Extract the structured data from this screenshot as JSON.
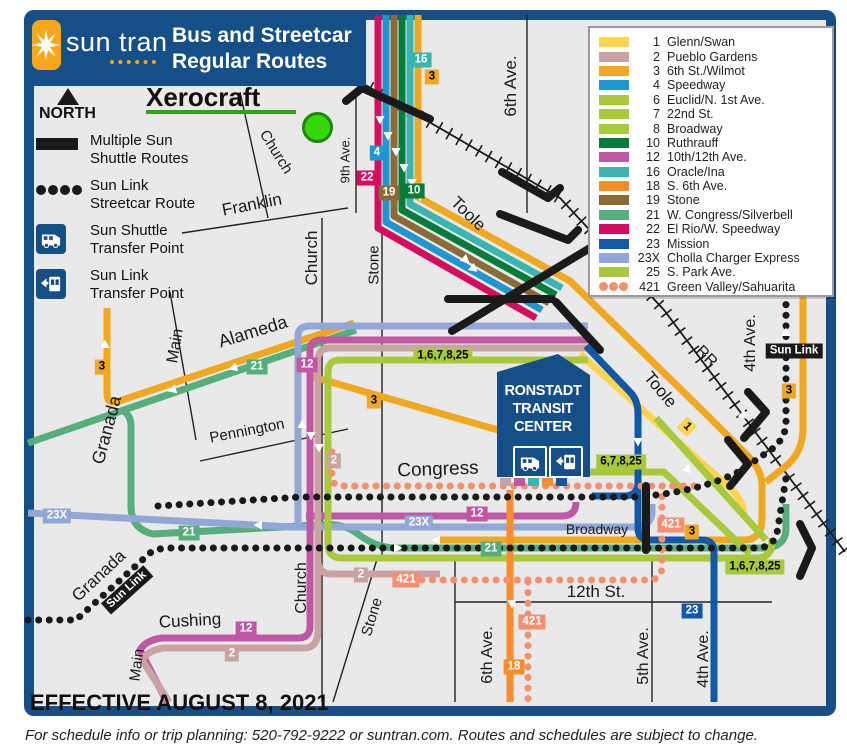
{
  "header": {
    "logo_text": "sun tran",
    "title_line1": "Bus and Streetcar",
    "title_line2": "Regular Routes"
  },
  "compass": {
    "label": "NORTH"
  },
  "poi": {
    "xerocraft": "Xerocraft"
  },
  "map_legend": {
    "items": [
      {
        "icon": "black-bar-swatch",
        "line1": "Multiple Sun",
        "line2": "Shuttle Routes"
      },
      {
        "icon": "black-dots-swatch",
        "line1": "Sun Link",
        "line2": "Streetcar Route"
      },
      {
        "icon": "bus-icon",
        "line1": "Sun Shuttle",
        "line2": "Transfer Point"
      },
      {
        "icon": "tram-icon",
        "line1": "Sun Link",
        "line2": "Transfer Point"
      }
    ]
  },
  "routes_legend": {
    "rows": [
      {
        "number": "1",
        "name": "Glenn/Swan",
        "color": "#FCD450"
      },
      {
        "number": "2",
        "name": "Pueblo Gardens",
        "color": "#C9A2A2"
      },
      {
        "number": "3",
        "name": "6th St./Wilmot",
        "color": "#EFA81F"
      },
      {
        "number": "4",
        "name": "Speedway",
        "color": "#1F96D2"
      },
      {
        "number": "6",
        "name": "Euclid/N. 1st Ave.",
        "color": "#A9C93D"
      },
      {
        "number": "7",
        "name": "22nd St.",
        "color": "#A9C93D"
      },
      {
        "number": "8",
        "name": "Broadway",
        "color": "#A9C93D"
      },
      {
        "number": "10",
        "name": "Ruthrauff",
        "color": "#067C3C"
      },
      {
        "number": "12",
        "name": "10th/12th Ave.",
        "color": "#BF57A5"
      },
      {
        "number": "16",
        "name": "Oracle/Ina",
        "color": "#3BB5B0"
      },
      {
        "number": "18",
        "name": "S. 6th Ave.",
        "color": "#F78D2D"
      },
      {
        "number": "19",
        "name": "Stone",
        "color": "#8A6A36"
      },
      {
        "number": "21",
        "name": "W. Congress/Silverbell",
        "color": "#56AE7C"
      },
      {
        "number": "22",
        "name": "El Rio/W. Speedway",
        "color": "#D40D5F"
      },
      {
        "number": "23",
        "name": "Mission",
        "color": "#1158A7"
      },
      {
        "number": "23X",
        "name": "Cholla Charger Express",
        "color": "#93A7D6"
      },
      {
        "number": "25",
        "name": "S. Park Ave.",
        "color": "#A9C93D"
      },
      {
        "number": "421",
        "name": "Green Valley/Sahuarita",
        "color": "#F29070",
        "dots": true
      }
    ]
  },
  "transit_center": {
    "line1": "RONSTADT",
    "line2": "TRANSIT",
    "line3": "CENTER"
  },
  "effective_date": "EFFECTIVE AUGUST 8, 2021",
  "footer": "For schedule info or trip planning: 520-792-9222 or suntran.com. Routes and schedules are subject to change.",
  "colors": {
    "brand_blue": "#164E87",
    "map_bg": "#E9E9EA",
    "logo_orange": "#F5A81C",
    "xerocraft_green": "#2CA60E",
    "sun_link_black": "#1a1a1a"
  },
  "map": {
    "street_labels": [
      {
        "text": "6th Ave.",
        "x": 511,
        "y": 86,
        "rot": -90,
        "size": 17
      },
      {
        "text": "9th Ave.",
        "x": 345,
        "y": 160,
        "rot": -90,
        "size": 13
      },
      {
        "text": "Church",
        "x": 276,
        "y": 152,
        "rot": 58,
        "size": 15
      },
      {
        "text": "Franklin",
        "x": 252,
        "y": 205,
        "rot": -11,
        "size": 17
      },
      {
        "text": "Church",
        "x": 312,
        "y": 258,
        "rot": -90,
        "size": 17
      },
      {
        "text": "Stone",
        "x": 374,
        "y": 265,
        "rot": -90,
        "size": 15
      },
      {
        "text": "Toole",
        "x": 468,
        "y": 214,
        "rot": 44,
        "size": 17
      },
      {
        "text": "Toole",
        "x": 660,
        "y": 390,
        "rot": 50,
        "size": 17
      },
      {
        "text": "RR",
        "x": 706,
        "y": 357,
        "rot": 45,
        "size": 16
      },
      {
        "text": "Main",
        "x": 176,
        "y": 346,
        "rot": -80,
        "size": 16
      },
      {
        "text": "Alameda",
        "x": 253,
        "y": 332,
        "rot": -17,
        "size": 18
      },
      {
        "text": "Granada",
        "x": 107,
        "y": 430,
        "rot": -75,
        "size": 18
      },
      {
        "text": "Pennington",
        "x": 247,
        "y": 431,
        "rot": -11,
        "size": 15
      },
      {
        "text": "Congress",
        "x": 438,
        "y": 470,
        "rot": -2,
        "size": 19
      },
      {
        "text": "Broadway",
        "x": 597,
        "y": 529,
        "rot": 0,
        "size": 14
      },
      {
        "text": "4th Ave.",
        "x": 751,
        "y": 343,
        "rot": -90,
        "size": 16
      },
      {
        "text": "12th St.",
        "x": 596,
        "y": 592,
        "rot": 0,
        "size": 17
      },
      {
        "text": "Granada",
        "x": 99,
        "y": 576,
        "rot": -43,
        "size": 17
      },
      {
        "text": "Cushing",
        "x": 190,
        "y": 621,
        "rot": -3,
        "size": 17
      },
      {
        "text": "Main",
        "x": 137,
        "y": 665,
        "rot": -82,
        "size": 15
      },
      {
        "text": "Church",
        "x": 302,
        "y": 588,
        "rot": -90,
        "size": 16
      },
      {
        "text": "Stone",
        "x": 372,
        "y": 617,
        "rot": -73,
        "size": 15
      },
      {
        "text": "6th Ave.",
        "x": 488,
        "y": 655,
        "rot": -90,
        "size": 16
      },
      {
        "text": "5th Ave.",
        "x": 644,
        "y": 656,
        "rot": -90,
        "size": 16
      },
      {
        "text": "4th Ave.",
        "x": 704,
        "y": 659,
        "rot": -90,
        "size": 16
      }
    ],
    "badges": [
      {
        "t": "16",
        "x": 421,
        "y": 60,
        "bg": "#3BB5B0",
        "fg": "#fff"
      },
      {
        "t": "3",
        "x": 432,
        "y": 77,
        "bg": "#EFA81F",
        "fg": "#000"
      },
      {
        "t": "4",
        "x": 377,
        "y": 153,
        "bg": "#1F96D2",
        "fg": "#fff"
      },
      {
        "t": "22",
        "x": 367,
        "y": 178,
        "bg": "#D40D5F",
        "fg": "#fff"
      },
      {
        "t": "19",
        "x": 389,
        "y": 193,
        "bg": "#8A6A36",
        "fg": "#fff"
      },
      {
        "t": "10",
        "x": 414,
        "y": 191,
        "bg": "#067C3C",
        "fg": "#fff"
      },
      {
        "t": "3",
        "x": 102,
        "y": 367,
        "bg": "#EFA81F",
        "fg": "#000"
      },
      {
        "t": "21",
        "x": 257,
        "y": 367,
        "bg": "#56AE7C",
        "fg": "#fff"
      },
      {
        "t": "12",
        "x": 307,
        "y": 365,
        "bg": "#BF57A5",
        "fg": "#fff"
      },
      {
        "t": "1,6,7,8,25",
        "x": 443,
        "y": 356,
        "bg": "#A9C93D",
        "fg": "#000"
      },
      {
        "t": "3",
        "x": 374,
        "y": 401,
        "bg": "#EFA81F",
        "fg": "#000"
      },
      {
        "t": "2",
        "x": 334,
        "y": 461,
        "bg": "#C9A2A2",
        "fg": "#fff"
      },
      {
        "t": "6,7,8,25",
        "x": 621,
        "y": 462,
        "bg": "#A9C93D",
        "fg": "#000"
      },
      {
        "t": "421",
        "x": 671,
        "y": 525,
        "bg": "#F29070",
        "fg": "#fff"
      },
      {
        "t": "12",
        "x": 477,
        "y": 514,
        "bg": "#BF57A5",
        "fg": "#fff"
      },
      {
        "t": "23X",
        "x": 419,
        "y": 523,
        "bg": "#93A7D6",
        "fg": "#fff"
      },
      {
        "t": "23X",
        "x": 57,
        "y": 516,
        "bg": "#93A7D6",
        "fg": "#fff"
      },
      {
        "t": "21",
        "x": 189,
        "y": 533,
        "bg": "#56AE7C",
        "fg": "#fff"
      },
      {
        "t": "21",
        "x": 491,
        "y": 549,
        "bg": "#56AE7C",
        "fg": "#fff"
      },
      {
        "t": "3",
        "x": 692,
        "y": 532,
        "bg": "#EFA81F",
        "fg": "#000"
      },
      {
        "t": "1,6,7,8,25",
        "x": 755,
        "y": 567,
        "bg": "#A9C93D",
        "fg": "#000"
      },
      {
        "t": "2",
        "x": 361,
        "y": 575,
        "bg": "#C9A2A2",
        "fg": "#fff"
      },
      {
        "t": "421",
        "x": 406,
        "y": 580,
        "bg": "#F29070",
        "fg": "#fff"
      },
      {
        "t": "421",
        "x": 532,
        "y": 622,
        "bg": "#F29070",
        "fg": "#fff"
      },
      {
        "t": "18",
        "x": 514,
        "y": 667,
        "bg": "#F78D2D",
        "fg": "#fff"
      },
      {
        "t": "23",
        "x": 692,
        "y": 611,
        "bg": "#1158A7",
        "fg": "#fff"
      },
      {
        "t": "12",
        "x": 246,
        "y": 629,
        "bg": "#BF57A5",
        "fg": "#fff"
      },
      {
        "t": "2",
        "x": 232,
        "y": 654,
        "bg": "#C9A2A2",
        "fg": "#fff"
      },
      {
        "t": "3",
        "x": 789,
        "y": 391,
        "bg": "#EFA81F",
        "fg": "#000"
      },
      {
        "t": "1",
        "x": 687,
        "y": 427,
        "bg": "#FCD450",
        "fg": "#000",
        "rot": 45
      },
      {
        "t": "Sun Link",
        "x": 794,
        "y": 351,
        "bg": "#1a1a1a",
        "fg": "#fff"
      },
      {
        "t": "Sun Link",
        "x": 127,
        "y": 590,
        "bg": "#1a1a1a",
        "fg": "#fff",
        "rot": -42
      }
    ],
    "arrows": [
      [
        380,
        120,
        180
      ],
      [
        388,
        136,
        180
      ],
      [
        396,
        152,
        180
      ],
      [
        404,
        168,
        180
      ],
      [
        412,
        183,
        180
      ],
      [
        420,
        197,
        180
      ],
      [
        466,
        260,
        130
      ],
      [
        474,
        269,
        130
      ],
      [
        233,
        368,
        -107
      ],
      [
        172,
        390,
        -107
      ],
      [
        105,
        344,
        0
      ],
      [
        302,
        424,
        0
      ],
      [
        311,
        436,
        180
      ],
      [
        319,
        448,
        180
      ],
      [
        436,
        540,
        -90
      ],
      [
        398,
        548,
        90
      ],
      [
        258,
        525,
        -90
      ],
      [
        638,
        442,
        180
      ],
      [
        512,
        604,
        180
      ],
      [
        786,
        332,
        0
      ],
      [
        688,
        470,
        135
      ],
      [
        744,
        416,
        135
      ]
    ]
  }
}
